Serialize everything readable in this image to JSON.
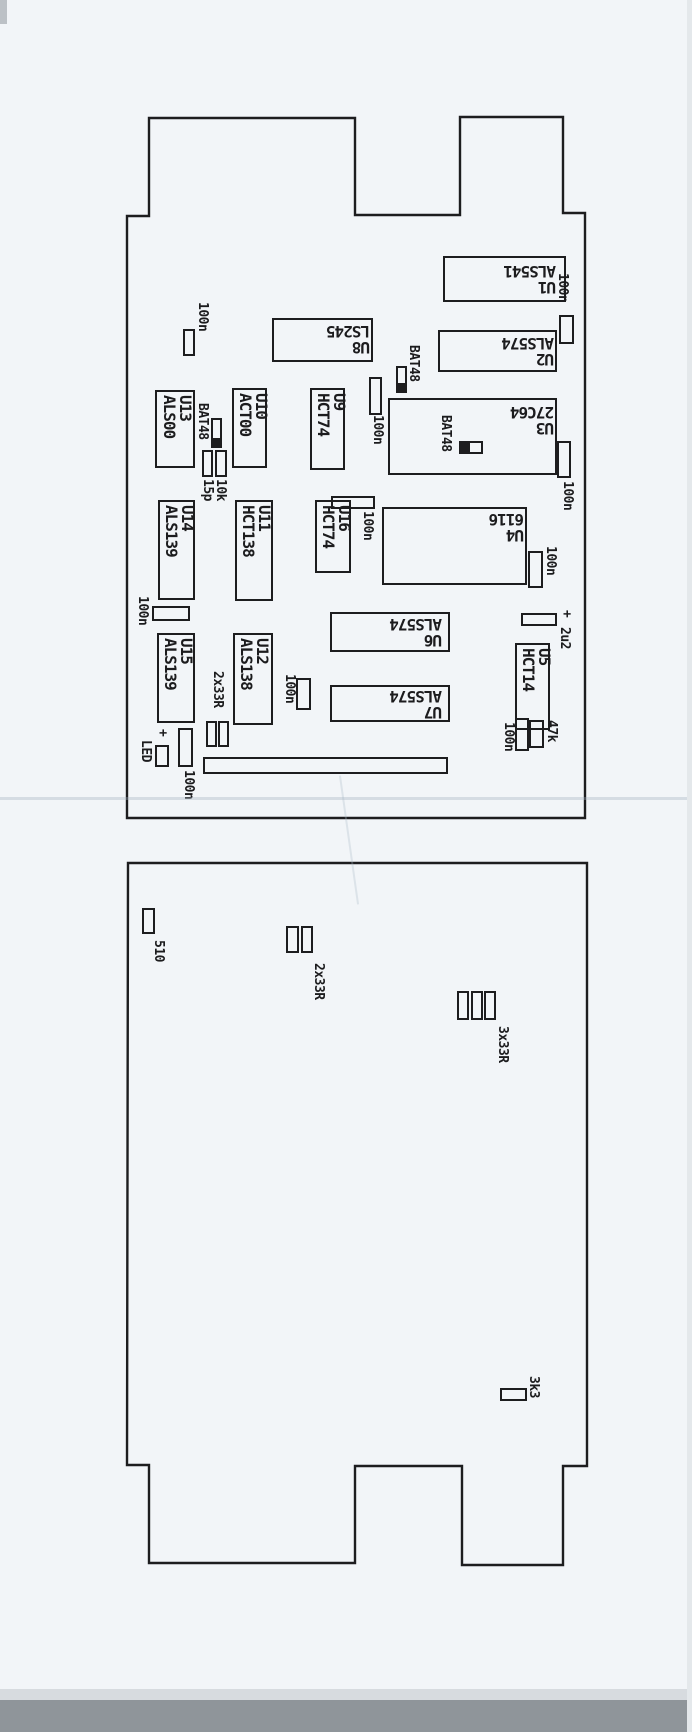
{
  "page": {
    "background": "#f2f5f8",
    "ink": "#1d1d1f",
    "description_labels_rotation": "labels printed rotated on scanned PCB placement drawing"
  },
  "boards": [
    {
      "name": "pcb-top-board",
      "outline_path": "M149,118 H355 V215 H460 V117 H563 V213 H585 V818 H127 V216 H149 Z",
      "ics": [
        {
          "ref": "U1",
          "part": "ALS541",
          "rect": [
            443,
            256,
            123,
            46
          ],
          "label_rot": 180,
          "label_box": [
            462,
            262,
            94,
            33
          ]
        },
        {
          "ref": "U2",
          "part": "ALS574",
          "rect": [
            438,
            330,
            119,
            42
          ],
          "label_rot": 180,
          "label_box": [
            456,
            334,
            98,
            33
          ]
        },
        {
          "ref": "U8",
          "part": "LS245",
          "rect": [
            272,
            318,
            101,
            44
          ],
          "label_rot": 180,
          "label_box": [
            280,
            323,
            90,
            32
          ]
        },
        {
          "ref": "U3",
          "part": "27C64",
          "rect": [
            388,
            398,
            169,
            77
          ],
          "label_rot": 180,
          "label_box": [
            466,
            404,
            88,
            32
          ]
        },
        {
          "ref": "U4",
          "part": "6116",
          "rect": [
            382,
            507,
            145,
            78
          ],
          "label_rot": 180,
          "label_box": [
            456,
            511,
            68,
            32
          ]
        },
        {
          "ref": "U6",
          "part": "ALS574",
          "rect": [
            330,
            612,
            120,
            40
          ],
          "label_rot": 180,
          "label_box": [
            344,
            616,
            98,
            32
          ]
        },
        {
          "ref": "U7",
          "part": "ALS574",
          "rect": [
            330,
            685,
            120,
            37
          ],
          "label_rot": 180,
          "label_box": [
            344,
            688,
            98,
            32
          ]
        },
        {
          "ref": "U13",
          "part": "ALS00",
          "rect": [
            155,
            390,
            40,
            78
          ],
          "label_rot": 90,
          "label_anchor": [
            161,
            395
          ]
        },
        {
          "ref": "U10",
          "part": "ACT00",
          "rect": [
            232,
            388,
            35,
            80
          ],
          "label_rot": 90,
          "label_anchor": [
            237,
            393
          ]
        },
        {
          "ref": "U9",
          "part": "HCT74",
          "rect": [
            310,
            388,
            35,
            82
          ],
          "label_rot": 90,
          "label_anchor": [
            315,
            393
          ]
        },
        {
          "ref": "U14",
          "part": "ALS139",
          "rect": [
            158,
            500,
            37,
            100
          ],
          "label_rot": 90,
          "label_anchor": [
            163,
            505
          ]
        },
        {
          "ref": "U11",
          "part": "HCT138",
          "rect": [
            235,
            500,
            38,
            101
          ],
          "label_rot": 90,
          "label_anchor": [
            240,
            505
          ]
        },
        {
          "ref": "U16",
          "part": "HCT74",
          "rect": [
            315,
            500,
            36,
            73
          ],
          "label_rot": 90,
          "label_anchor": [
            320,
            505
          ]
        },
        {
          "ref": "U15",
          "part": "ALS139",
          "rect": [
            157,
            633,
            38,
            90
          ],
          "label_rot": 90,
          "label_anchor": [
            162,
            638
          ]
        },
        {
          "ref": "U12",
          "part": "ALS138",
          "rect": [
            233,
            633,
            40,
            92
          ],
          "label_rot": 90,
          "label_anchor": [
            238,
            638
          ]
        },
        {
          "ref": "U5",
          "part": "HCT14",
          "rect": [
            515,
            643,
            35,
            87
          ],
          "label_rot": 90,
          "label_anchor": [
            520,
            648
          ]
        }
      ],
      "parts": [
        {
          "name": "cap-100n-1",
          "label": "100n",
          "label_pos": [
            196,
            302
          ],
          "rects": [
            [
              183,
              329,
              12,
              27
            ]
          ]
        },
        {
          "name": "cap-100n-2",
          "label": "100n",
          "label_pos": [
            556,
            273
          ],
          "rects": [
            [
              559,
              315,
              15,
              29
            ]
          ]
        },
        {
          "name": "diode-bat48-1",
          "label": "BAT48",
          "label_pos": [
            407,
            345
          ],
          "rects": [
            [
              396,
              366,
              11,
              27,
              "band-b"
            ]
          ]
        },
        {
          "name": "cap-100n-3",
          "label": "100n",
          "label_pos": [
            371,
            415
          ],
          "rects": [
            [
              369,
              377,
              13,
              38
            ]
          ]
        },
        {
          "name": "diode-bat48-2",
          "label": "BAT48",
          "label_pos": [
            196,
            403
          ],
          "rects": [
            [
              211,
              418,
              11,
              30,
              "band-b"
            ]
          ]
        },
        {
          "name": "cap-15p",
          "label": "15p",
          "label_pos": [
            201,
            479
          ],
          "rects": [
            [
              202,
              450,
              11,
              27
            ]
          ]
        },
        {
          "name": "res-10k",
          "label": "10k",
          "label_pos": [
            214,
            479
          ],
          "rects": [
            [
              215,
              450,
              12,
              27
            ]
          ]
        },
        {
          "name": "diode-bat48-3",
          "label": "BAT48",
          "label_pos": [
            439,
            415
          ],
          "rects": [
            [
              459,
              441,
              24,
              13,
              "band-l"
            ]
          ]
        },
        {
          "name": "cap-100n-4",
          "label": "100n",
          "label_pos": [
            561,
            481
          ],
          "rects": [
            [
              557,
              441,
              14,
              37
            ]
          ]
        },
        {
          "name": "cap-100n-5",
          "label": "100n",
          "label_pos": [
            136,
            596
          ],
          "rects": [
            [
              152,
              606,
              38,
              15
            ]
          ]
        },
        {
          "name": "cap-100n-6",
          "label": "100n",
          "label_pos": [
            361,
            511
          ],
          "rects": [
            [
              331,
              496,
              44,
              13
            ]
          ]
        },
        {
          "name": "cap-100n-7",
          "label": "100n",
          "label_pos": [
            544,
            546
          ],
          "rects": [
            [
              528,
              551,
              15,
              37
            ]
          ]
        },
        {
          "name": "res-2x33r",
          "label": "2x33R",
          "label_pos": [
            211,
            671
          ],
          "rects": [
            [
              206,
              721,
              11,
              26
            ],
            [
              218,
              721,
              11,
              26
            ]
          ]
        },
        {
          "name": "cap-2u2-plus",
          "label": "+",
          "label_pos": [
            560,
            610
          ],
          "rects": [
            [
              521,
              613,
              36,
              13
            ]
          ]
        },
        {
          "name": "cap-2u2",
          "label": "2u2",
          "label_pos": [
            558,
            627
          ],
          "rects": []
        },
        {
          "name": "cap-100n-8",
          "label": "100n",
          "label_pos": [
            283,
            674
          ],
          "rects": [
            [
              296,
              678,
              15,
              32
            ]
          ]
        },
        {
          "name": "led-plus",
          "label": "+",
          "label_pos": [
            156,
            729
          ],
          "rects": []
        },
        {
          "name": "led",
          "label": "LED",
          "label_pos": [
            139,
            740
          ],
          "rects": [
            [
              155,
              745,
              14,
              22
            ]
          ]
        },
        {
          "name": "cap-100n-9",
          "label": "100n",
          "label_pos": [
            182,
            770
          ],
          "rects": [
            [
              178,
              728,
              15,
              39
            ]
          ]
        },
        {
          "name": "edge-connector",
          "label": "",
          "label_pos": [
            0,
            0
          ],
          "rects": [
            [
              203,
              757,
              245,
              17
            ]
          ]
        },
        {
          "name": "cap-100n-10",
          "label": "100n",
          "label_pos": [
            502,
            722
          ],
          "rects": [
            [
              515,
              718,
              14,
              33
            ]
          ]
        },
        {
          "name": "res-47k",
          "label": "47k",
          "label_pos": [
            545,
            720
          ],
          "rects": [
            [
              529,
              720,
              15,
              28
            ]
          ]
        }
      ]
    },
    {
      "name": "pcb-bottom-board",
      "outline_path": "M128,863 H587 V1466 H563 V1565 H462 V1466 H355 V1563 H149 V1465 H127 Z",
      "ics": [],
      "parts": [
        {
          "name": "res-510",
          "label": "510",
          "label_pos": [
            152,
            940
          ],
          "rects": [
            [
              142,
              908,
              13,
              26
            ]
          ]
        },
        {
          "name": "res-2x33r-b",
          "label": "2x33R",
          "label_pos": [
            312,
            963
          ],
          "rects": [
            [
              286,
              926,
              13,
              27
            ],
            [
              301,
              926,
              12,
              27
            ]
          ]
        },
        {
          "name": "res-3x33r",
          "label": "3x33R",
          "label_pos": [
            496,
            1026
          ],
          "rects": [
            [
              457,
              991,
              12,
              29
            ],
            [
              471,
              991,
              12,
              29
            ],
            [
              484,
              991,
              12,
              29
            ]
          ]
        },
        {
          "name": "res-3k3",
          "label": "3k3",
          "label_pos": [
            527,
            1376
          ],
          "rects": [
            [
              500,
              1388,
              27,
              13
            ]
          ]
        }
      ]
    }
  ],
  "artifacts": [
    {
      "name": "scanner-edge-top-left",
      "x": 0,
      "y": 0,
      "w": 7,
      "h": 24,
      "color": "#bcc1c6"
    },
    {
      "name": "fold-crease",
      "x": 0,
      "y": 797,
      "w": 692,
      "h": 3,
      "color": "rgba(160,175,190,0.35)"
    },
    {
      "name": "fold-crease-diagonal",
      "x": 348,
      "y": 775,
      "w": 2,
      "h": 130,
      "color": "rgba(170,185,200,0.30)",
      "rot": -8
    },
    {
      "name": "paper-edge-shadow",
      "x": 0,
      "y": 1689,
      "w": 692,
      "h": 11,
      "color": "#d7dbdf"
    },
    {
      "name": "scanner-bed-strip",
      "x": 0,
      "y": 1700,
      "w": 692,
      "h": 32,
      "color": "#8f959a"
    },
    {
      "name": "right-edge-shade",
      "x": 687,
      "y": 0,
      "w": 5,
      "h": 1732,
      "color": "#e4e8eb"
    }
  ]
}
